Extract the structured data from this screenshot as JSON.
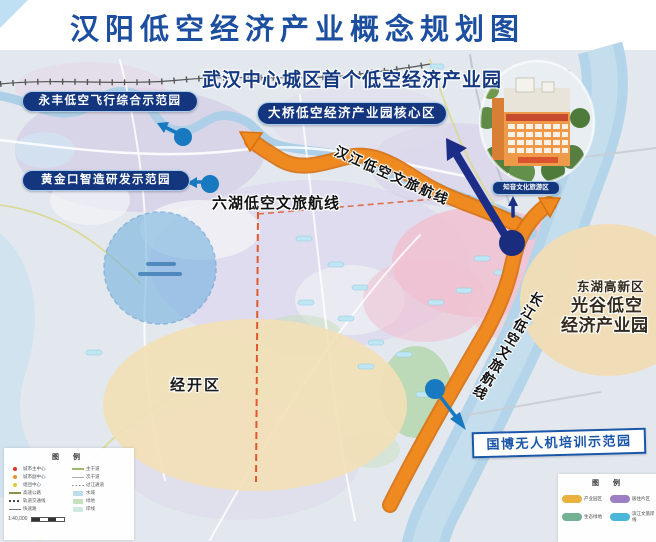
{
  "title": "汉阳低空经济产业概念规划图",
  "banner": "武汉中心城区首个低空经济产业园",
  "callouts": {
    "yongfeng": "永丰低空飞行综合示范园",
    "huangjinkou": "黄金口智造研发示范园",
    "daqiao": "大桥低空经济产业园核心区",
    "zhiyin": "知音文化旅游区",
    "guobo": "国博无人机培训示范园"
  },
  "routes": {
    "hanjiang": "汉江低空文旅航线",
    "liuhu": "六湖低空文旅航线",
    "changjiang": "长江低空文旅航线"
  },
  "regions": {
    "jingkai": "经开区",
    "donghu_line1": "东湖高新区",
    "donghu_line2": "光谷低空",
    "donghu_line3": "经济产业园"
  },
  "legend_left": {
    "title": "图 例",
    "col1": [
      {
        "label": "城市主中心"
      },
      {
        "label": "城市副中心"
      },
      {
        "label": "组团中心"
      },
      {
        "label": "高速公路"
      },
      {
        "label": "轨道交通线"
      },
      {
        "label": "快速路"
      }
    ],
    "col2": [
      {
        "label": "主干道"
      },
      {
        "label": "次干道"
      },
      {
        "label": "过江通道"
      },
      {
        "label": "水域"
      },
      {
        "label": "绿地"
      },
      {
        "label": "岸线"
      }
    ],
    "scale": "1:40,000"
  },
  "legend_right": {
    "title": "图 例",
    "items": [
      {
        "label": "产业园区",
        "color": "#eab13e"
      },
      {
        "label": "居住片区",
        "color": "#9d7fc6"
      },
      {
        "label": "生态绿地",
        "color": "#72b193"
      },
      {
        "label": "滨江文旅岸线",
        "color": "#49b6da"
      }
    ]
  },
  "colors": {
    "title_blue": "#1d4fa1",
    "pill_navy": "#13367e",
    "route_orange": "#ee8a1c",
    "marker_blue": "#1879c0",
    "navy_arrow": "#1b2d86"
  }
}
